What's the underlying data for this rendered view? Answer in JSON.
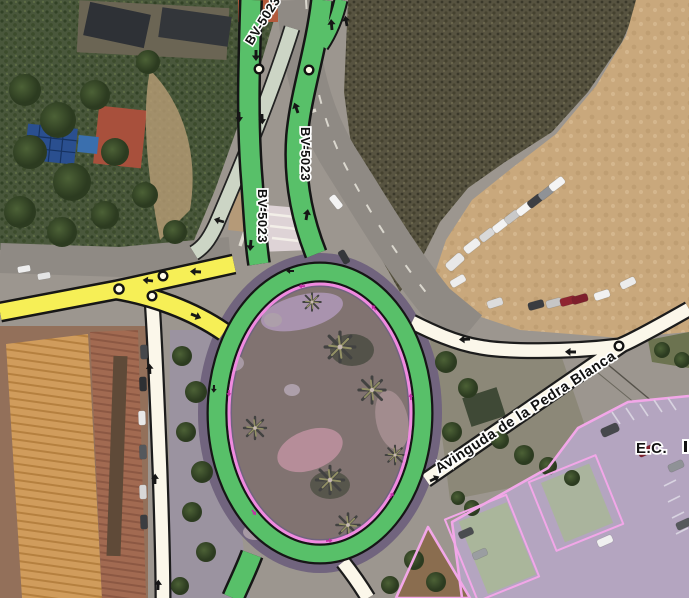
{
  "map": {
    "view": "satellite-aerial-with-route-overlays",
    "labels": {
      "route": "BV-5023",
      "avenue": "Avinguda de la Pedra Blanca",
      "poi": "E.C."
    },
    "colors": {
      "route_green": "#58c069",
      "route_yellow": "#f6ef56",
      "walkway_pink": "#f08ae0",
      "area_outline_pink": "#f2a7e8",
      "selection_tint_purple": "#8a5ab0",
      "road_white": "#fbf7ea",
      "road_sage": "#ccd5c5",
      "dirt_lot_tan": "#c9a87c"
    },
    "features": {
      "roundabout": "oval roundabout with palm trees, purple-tinted island",
      "parking_dirt": "unpaved parking lot with cars (top right)",
      "parking_outlined": "pink-outlined parking area (bottom right)",
      "rooftops": "terracotta apartment roofs (bottom left)"
    }
  }
}
